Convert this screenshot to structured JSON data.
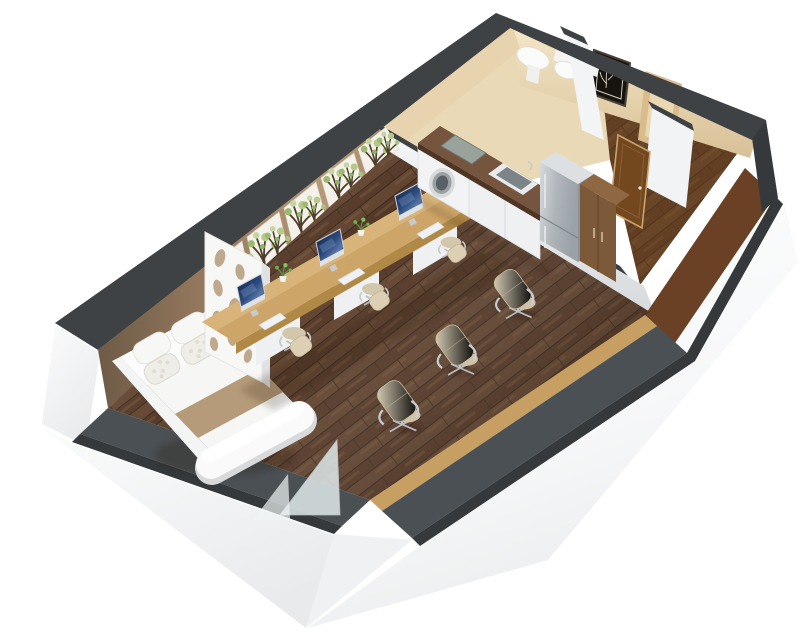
{
  "scene": {
    "type": "3d-floorplan-render",
    "view": "isometric cutaway of a studio apartment",
    "rooms": [
      {
        "id": "main-room",
        "purpose": "combined sleeping and workspace area",
        "floor": "dark walnut planks"
      },
      {
        "id": "kitchenette",
        "purpose": "kitchen strip along divider wall",
        "floor": "dark walnut planks"
      },
      {
        "id": "bathroom",
        "purpose": "bathroom with basin and toilet",
        "floor": "beige tile"
      },
      {
        "id": "entry-hall",
        "purpose": "entry corridor with wooden door",
        "floor": "brown wood"
      }
    ],
    "furniture": [
      "double-bed",
      "pillows-x4",
      "bed-runner",
      "foot-bench",
      "decorative-partition-screen",
      "glass-panel",
      "long-office-desk",
      "imac-monitor-x3",
      "keyboard-x3",
      "desk-plant-x3",
      "desk-chair-x3",
      "guest-chair-x3",
      "wall-wood-ledge",
      "tree-mural-panels-x5",
      "kitchen-counter",
      "washing-machine",
      "cooktop",
      "kitchen-sink",
      "refrigerator",
      "wardrobe-cabinet",
      "wash-basin",
      "toilet",
      "shower-shelf",
      "framed-wall-art",
      "door-frame",
      "wooden-entry-door"
    ],
    "counts": {
      "monitors": 3,
      "desk_chairs": 3,
      "guest_chairs": 3,
      "mural_panels": 5,
      "pillows": 4
    }
  },
  "colors": {
    "background": "#ffffff",
    "wall_top": "#3e4245",
    "wall_top_near": "#35393b",
    "wall_tan": "#a08467",
    "wall_beige": "#ead9b6",
    "slate_wall": "#4b5054",
    "floor_dark": "#5a3f2c",
    "entry_floor": "#74481f",
    "desk_oak": "#cda568",
    "desk_oak_dark": "#b08947",
    "ledge_wood": "#c79f63",
    "mural_panel": "#f3f1ea",
    "tree_trunk": "#4e3e2b",
    "tree_leaf": "#a9c47e",
    "bedding_white": "#f6f6f4",
    "bed_runner": "#b59b79",
    "chair_beige": "#d8cbb0",
    "chrome": "#c0c4c8",
    "screen_navy": "#27416e",
    "appliance_white": "#f2f3f4",
    "fridge_steel": "#b7bcc1",
    "wardrobe_brown": "#7c5a39",
    "granite": "#6b4a36",
    "glass": "#dfe9ea",
    "exterior_shade": "#eceef0"
  }
}
